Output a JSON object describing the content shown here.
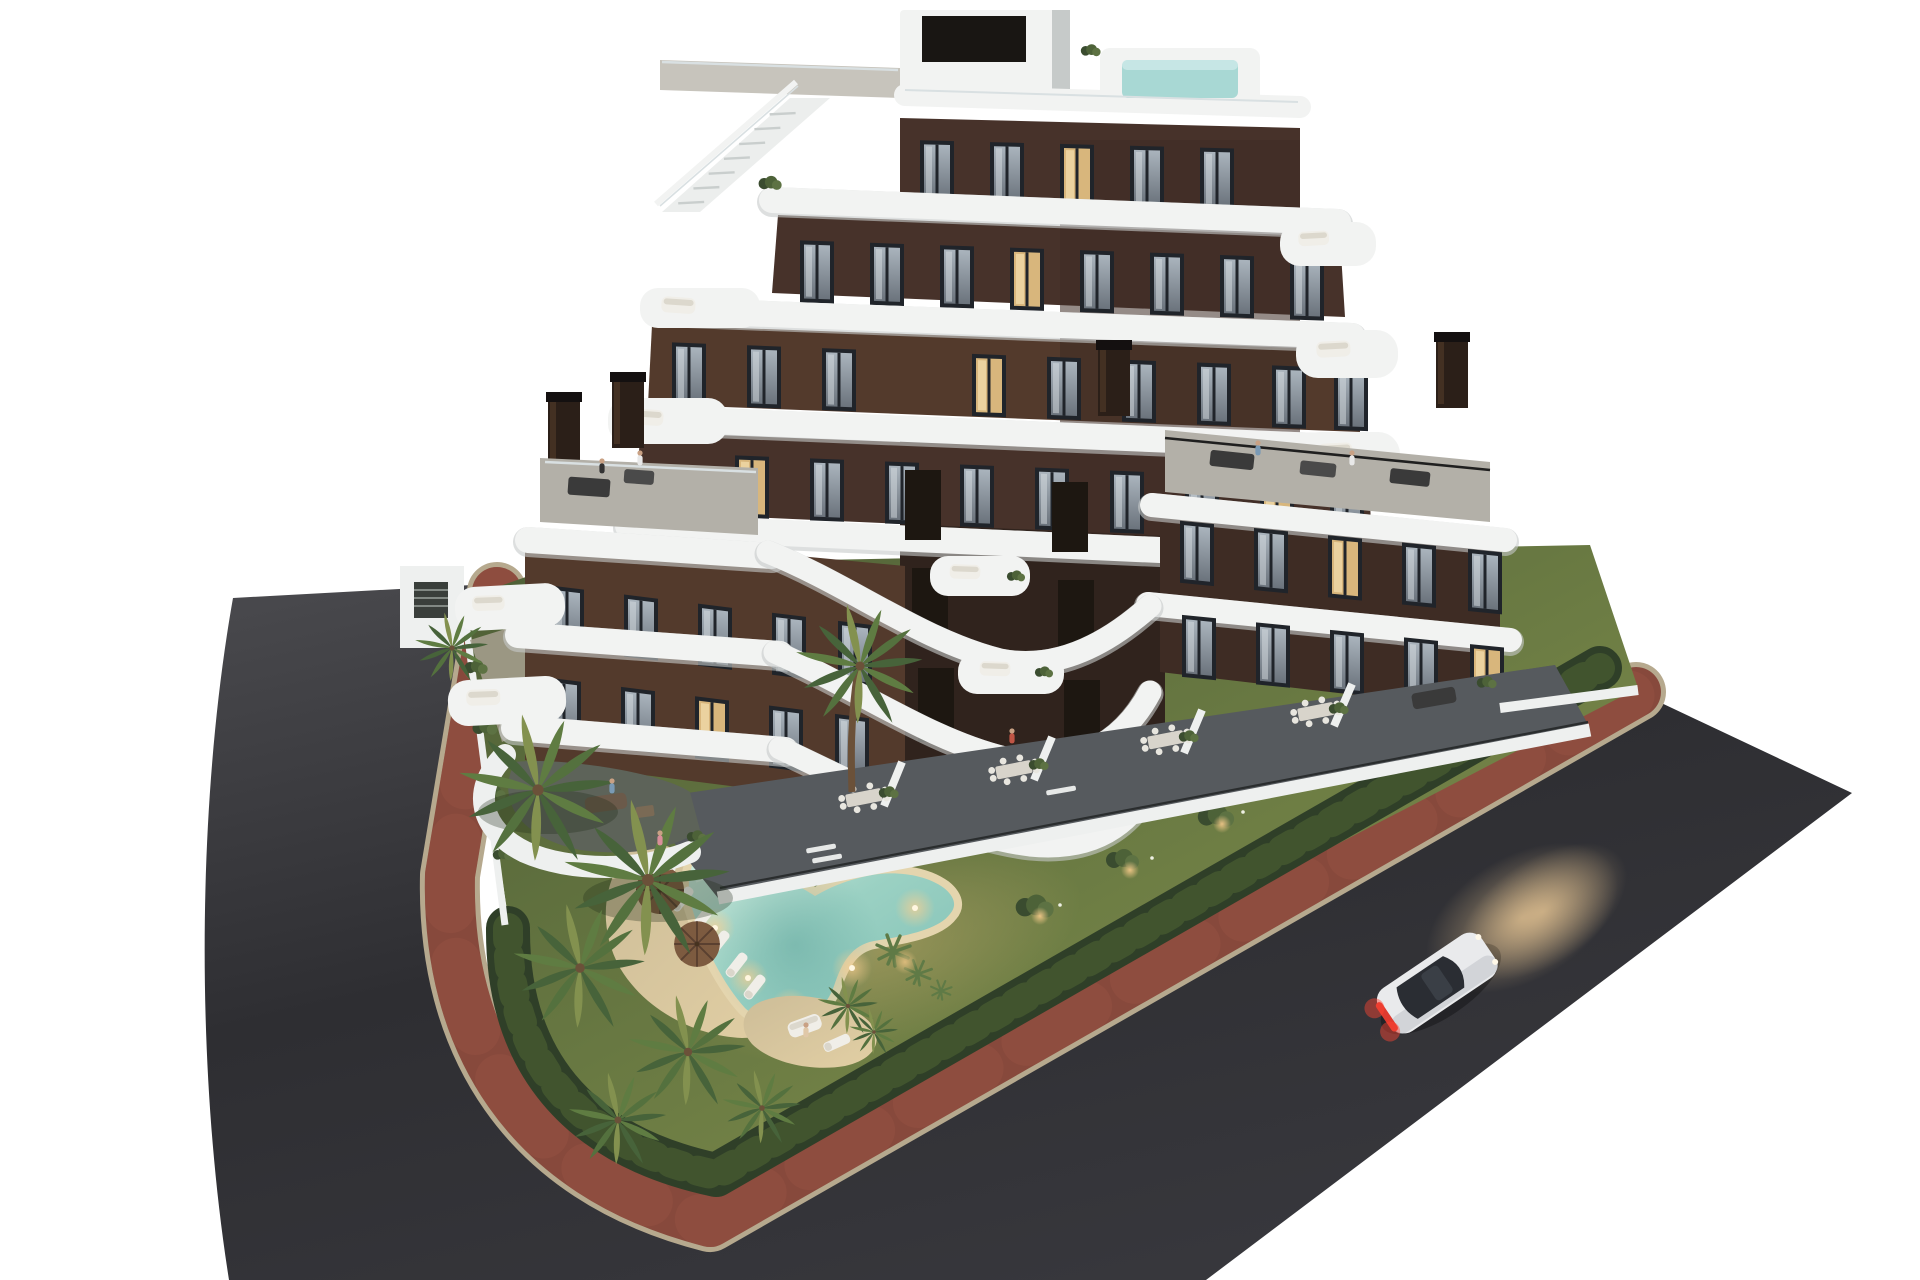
{
  "scene": {
    "kind": "architectural-3d-render",
    "time_of_day": "dusk",
    "background": "#ffffff"
  },
  "inventory": {
    "buildings": 1,
    "visible_floors": 7,
    "garden_pools": 1,
    "rooftop_pools": 1,
    "cars": 1,
    "parasols": 2,
    "sun_loungers": 7
  },
  "colors": {
    "bg": "#ffffff",
    "road_light": "#4a4a4e",
    "road_mid": "#2e2e32",
    "road_low": "#37373c",
    "curb": "#b6a98e",
    "sidewalk_red": "#87493c",
    "sidewalk_red_light": "#965143",
    "hedge_dark": "#2f3f28",
    "hedge_light": "#44582f",
    "grass_dark": "#4d5e36",
    "grass_mid": "#6d7d44",
    "grass_light": "#8a9551",
    "gravel": "#7d7668",
    "gravel_edge": "#a99f87",
    "sand": "#cdbd98",
    "sand_lit": "#e2cfa4",
    "pool_rim": "#e4d5ae",
    "water_edge": "#cfeadd",
    "water_mid": "#9bd1c3",
    "water_deep": "#7fbfb4",
    "facade_light": "#533a2c",
    "facade_mid": "#47322a",
    "facade_dark": "#3e2c24",
    "facade_recess": "#30231d",
    "band_white": "#f2f3f2",
    "band_shadow": "#c6cac9",
    "deck_gray": "#b3b0a8",
    "terrace_dark": "#565a5e",
    "patio_green": "#5d6359",
    "window_frame": "#20242a",
    "glass_light": "#aab4bd",
    "glass_dark": "#6b737c",
    "window_lit": "#d8b67c",
    "rooftop_pool_water": "#a8d8d4",
    "glass_rail": "#d9e0e2",
    "chimney": "#2b1f18",
    "chimney_cap": "#141010",
    "wall_white": "#eef0ef",
    "palm_dark": "#47633a",
    "palm_mid": "#5f7c42",
    "palm_yellow": "#83914f",
    "trunk": "#6b5139",
    "umbrella": "#7d5b40",
    "umbrella_rib": "#5a4030",
    "furniture_white": "#f0eee8",
    "furniture_dark": "#3a3a3a",
    "sofa_brown": "#6b5a4a",
    "car_body": "#e9eaec",
    "car_shade": "#c8cbd0",
    "car_glass": "#2a2d33",
    "taillight": "#e03a2f",
    "headlight_glow": "#ffd9a0",
    "warm_light": "#ffcf8e"
  }
}
